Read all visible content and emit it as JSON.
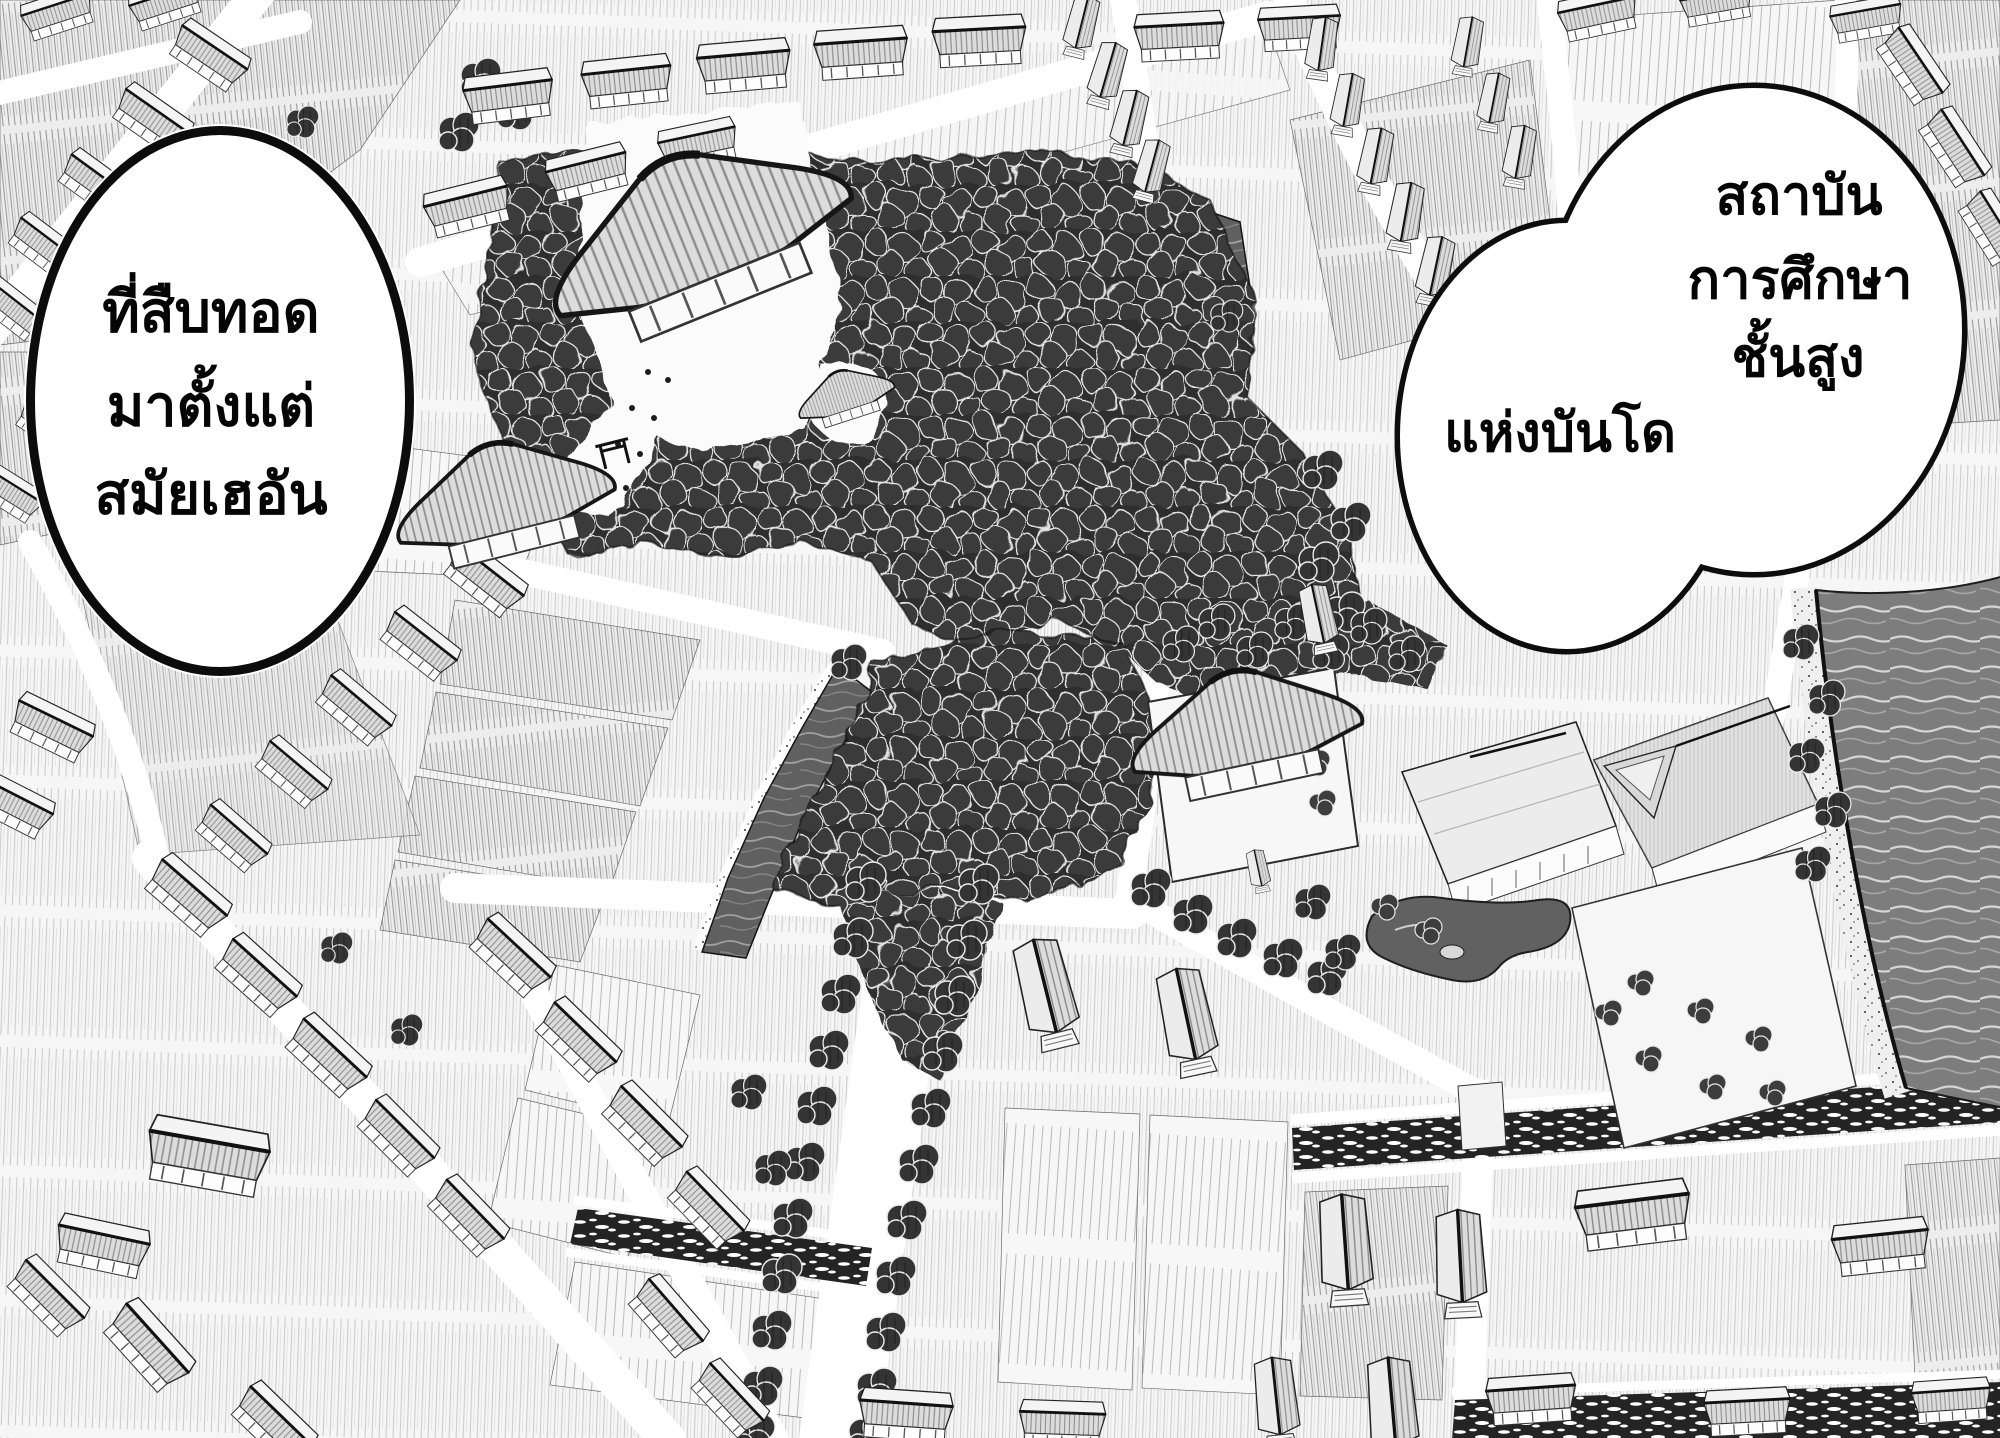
{
  "panel": {
    "bubbles": {
      "left": {
        "lines": [
          "ที่สืบทอด",
          "มาตั้งแต่",
          "สมัยเฮอัน"
        ]
      },
      "right": {
        "lines": [
          "สถาบัน",
          "การศึกษา",
          "ชั้นสูง",
          "แห่งบันโด"
        ]
      }
    },
    "colors": {
      "ink": "#0d0d0d",
      "paper": "#ffffff",
      "water": "#7d7d7d",
      "water_dark": "#606060",
      "forest": "#2f2f2f",
      "field_line": "#a6a6a6"
    }
  }
}
